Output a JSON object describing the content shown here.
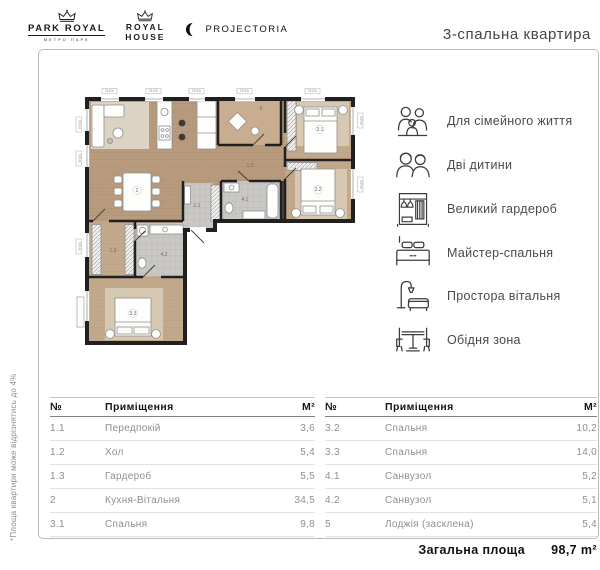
{
  "header": {
    "logos": {
      "park_royal": {
        "line1": "PARK ROYAL",
        "line2": "МЕТРО ПАРК"
      },
      "royal_house": {
        "line1": "ROYAL",
        "line2": "HOUSE"
      },
      "projectoria": {
        "name": "PROJECTORIA"
      }
    },
    "title": "3-спальна квартира"
  },
  "side_note": "*Площа квартири може відрізнятись до 4%",
  "plan": {
    "window_label": "ПНСК",
    "room_labels": {
      "r11": "1.1",
      "r12": "1.2",
      "r13": "1.3",
      "r2": "2",
      "r31": "3.1",
      "r32": "3.2",
      "r33": "3.3",
      "r41": "4.1",
      "r42": "4.2",
      "r5": "5"
    },
    "colors": {
      "wall": "#202020",
      "wood": "#b89b7e",
      "wood_light": "#c2a98c",
      "tile": "#c9c8c5",
      "rug": "#d9cdba"
    }
  },
  "features": [
    {
      "icon": "family-icon",
      "label": "Для сімейного життя"
    },
    {
      "icon": "children-icon",
      "label": "Дві дитини"
    },
    {
      "icon": "wardrobe-icon",
      "label": "Великий гардероб"
    },
    {
      "icon": "bed-icon",
      "label": "Майстер-спальня"
    },
    {
      "icon": "sofa-lamp-icon",
      "label": "Простора вітальня"
    },
    {
      "icon": "dining-icon",
      "label": "Обідня зона"
    }
  ],
  "tables": {
    "headers": {
      "num": "№",
      "room": "Приміщення",
      "area": "М²"
    },
    "left_rows": [
      {
        "num": "1.1",
        "room": "Передпокій",
        "area": "3,6"
      },
      {
        "num": "1.2",
        "room": "Хол",
        "area": "5,4"
      },
      {
        "num": "1.3",
        "room": "Гардероб",
        "area": "5,5"
      },
      {
        "num": "2",
        "room": "Кухня-Вітальня",
        "area": "34,5"
      },
      {
        "num": "3.1",
        "room": "Спальня",
        "area": "9,8"
      }
    ],
    "right_rows": [
      {
        "num": "3.2",
        "room": "Спальня",
        "area": "10,2"
      },
      {
        "num": "3.3",
        "room": "Спальня",
        "area": "14,0"
      },
      {
        "num": "4.1",
        "room": "Санвузол",
        "area": "5,2"
      },
      {
        "num": "4.2",
        "room": "Санвузол",
        "area": "5,1"
      },
      {
        "num": "5",
        "room": "Лоджія (засклена)",
        "area": "5,4"
      }
    ]
  },
  "total": {
    "label": "Загальна площа",
    "value": "98,7 m²"
  }
}
